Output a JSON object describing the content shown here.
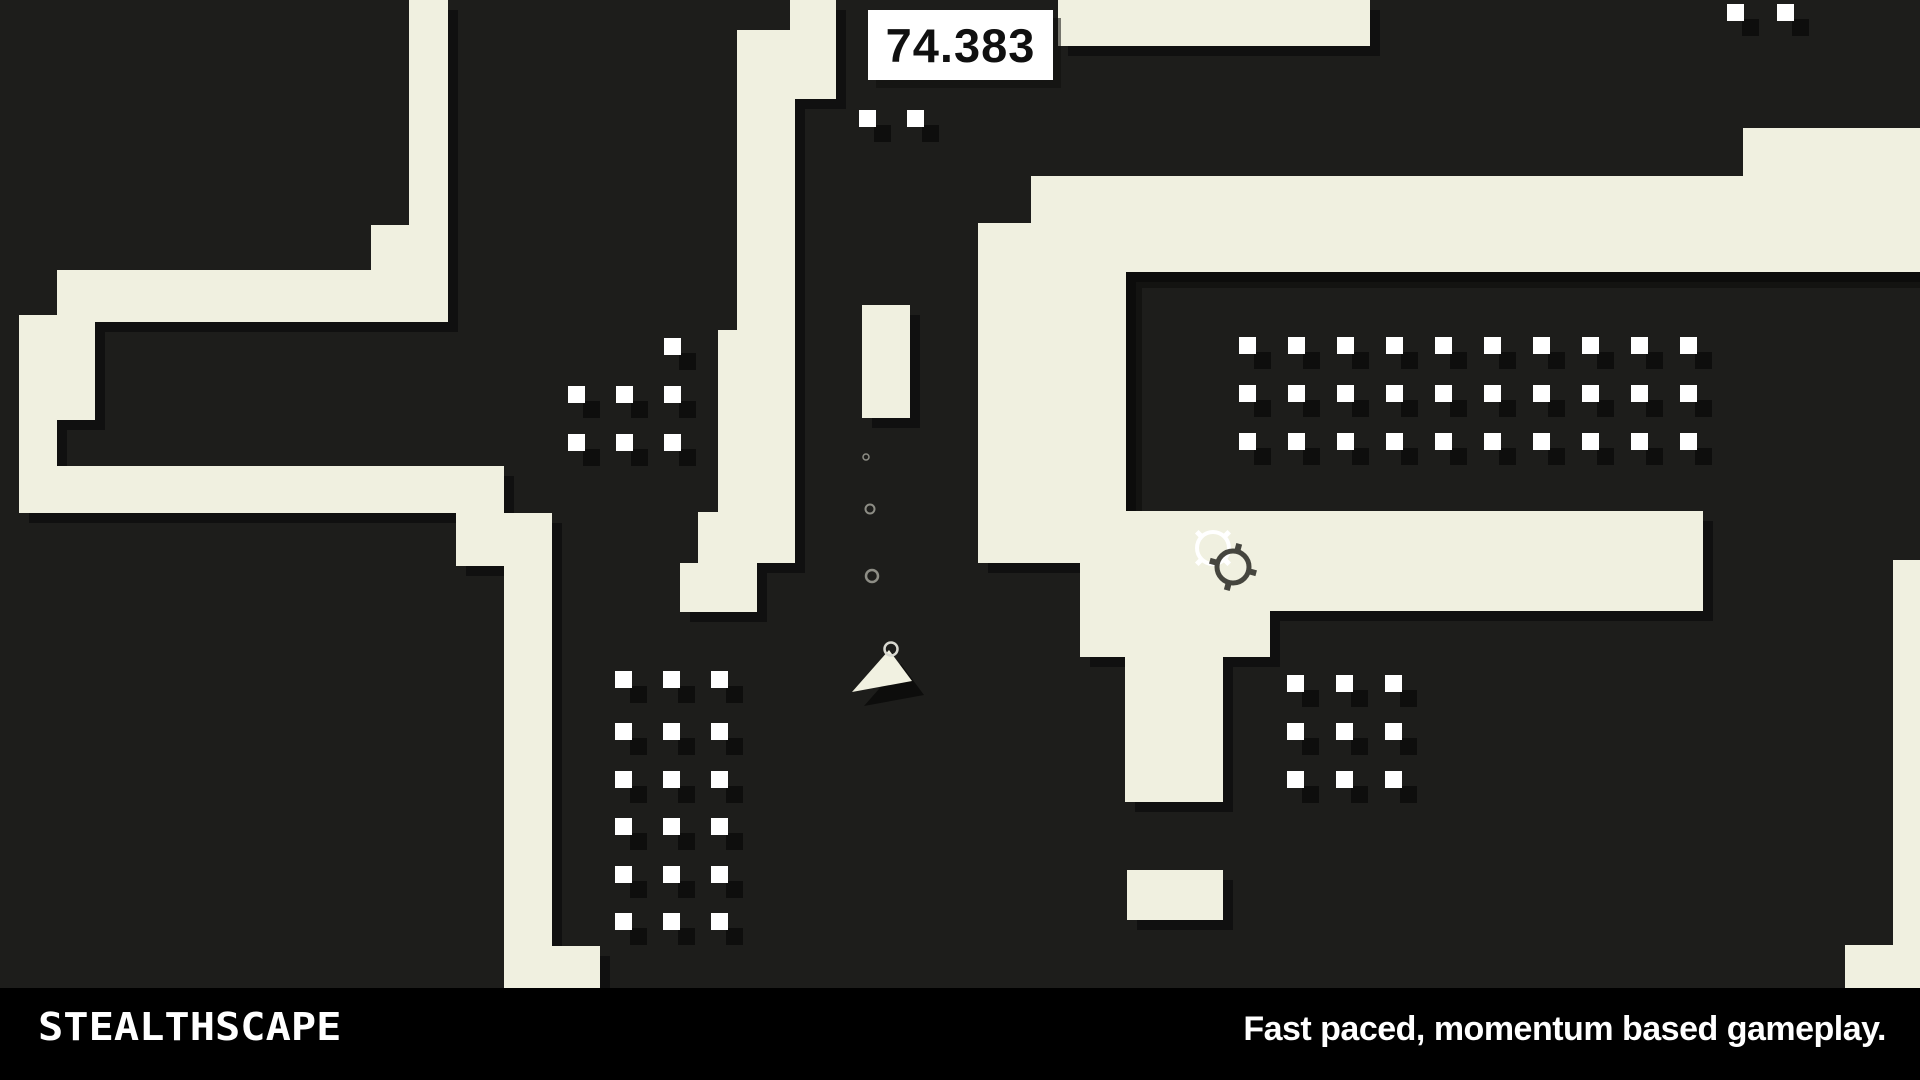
{
  "hud": {
    "timer_value": "74.383"
  },
  "branding": {
    "logo_text": "STEALTHSCAPE",
    "tagline": "Fast paced, momentum based gameplay."
  },
  "colors": {
    "background": "#1d1d1b",
    "wall": "#f0f0e0",
    "wall_shadow": "#101010",
    "dot": "#ffffff",
    "dot_shadow": "#0e0e0d",
    "bottom_bar": "#000000",
    "timer_box": "#ffffff",
    "timer_text": "#101010",
    "player": "#f1f1e1",
    "trail_ring": "#8d8d85",
    "crosshair_light": "#ffffff",
    "crosshair_dark": "#45453e"
  },
  "playfield": {
    "shadow_offset": {
      "x": 10,
      "y": 10
    },
    "dot_shadow_offset": {
      "x": 15,
      "y": 15
    },
    "walls": [
      {
        "name": "left-trunk",
        "x": 409,
        "y": 0,
        "w": 39,
        "h": 270
      },
      {
        "name": "left-trunk-step",
        "x": 371,
        "y": 225,
        "w": 38,
        "h": 45
      },
      {
        "name": "left-upper-bar",
        "x": 57,
        "y": 270,
        "w": 391,
        "h": 52
      },
      {
        "name": "left-end-top",
        "x": 19,
        "y": 315,
        "w": 76,
        "h": 45
      },
      {
        "name": "left-column",
        "x": 19,
        "y": 360,
        "w": 38,
        "h": 106
      },
      {
        "name": "left-column-step",
        "x": 57,
        "y": 360,
        "w": 38,
        "h": 60
      },
      {
        "name": "left-lower-bar",
        "x": 19,
        "y": 466,
        "w": 485,
        "h": 47
      },
      {
        "name": "left-stair",
        "x": 456,
        "y": 513,
        "w": 96,
        "h": 53
      },
      {
        "name": "left-corridor",
        "x": 504,
        "y": 513,
        "w": 48,
        "h": 433
      },
      {
        "name": "left-corridor-foot",
        "x": 504,
        "y": 946,
        "w": 96,
        "h": 42
      },
      {
        "name": "center-top-right",
        "x": 790,
        "y": 0,
        "w": 46,
        "h": 99
      },
      {
        "name": "center-upper",
        "x": 737,
        "y": 30,
        "w": 58,
        "h": 300
      },
      {
        "name": "center-lower",
        "x": 718,
        "y": 330,
        "w": 77,
        "h": 182
      },
      {
        "name": "center-wide",
        "x": 698,
        "y": 512,
        "w": 97,
        "h": 51
      },
      {
        "name": "center-bottom-step",
        "x": 680,
        "y": 563,
        "w": 77,
        "h": 49
      },
      {
        "name": "center-block",
        "x": 862,
        "y": 305,
        "w": 48,
        "h": 113
      },
      {
        "name": "right-top-strip",
        "x": 1058,
        "y": 0,
        "w": 312,
        "h": 46
      },
      {
        "name": "right-band-top",
        "x": 1031,
        "y": 176,
        "w": 889,
        "h": 96
      },
      {
        "name": "right-wall-stub",
        "x": 1743,
        "y": 128,
        "w": 177,
        "h": 48
      },
      {
        "name": "right-arm",
        "x": 978,
        "y": 223,
        "w": 148,
        "h": 340
      },
      {
        "name": "right-connector",
        "x": 1080,
        "y": 563,
        "w": 46,
        "h": 48
      },
      {
        "name": "right-band-bottom",
        "x": 1126,
        "y": 511,
        "w": 577,
        "h": 100
      },
      {
        "name": "right-band-step",
        "x": 1080,
        "y": 611,
        "w": 190,
        "h": 46
      },
      {
        "name": "right-descender",
        "x": 1125,
        "y": 657,
        "w": 98,
        "h": 145
      },
      {
        "name": "right-block",
        "x": 1127,
        "y": 870,
        "w": 96,
        "h": 50
      },
      {
        "name": "bottomright-sliver",
        "x": 1893,
        "y": 560,
        "w": 27,
        "h": 428
      },
      {
        "name": "bottomright-foot",
        "x": 1845,
        "y": 945,
        "w": 75,
        "h": 43
      }
    ],
    "interior_shade": {
      "x": 1126,
      "y": 272,
      "w": 794,
      "h": 239
    },
    "dot_size": 17,
    "dot_grids": [
      {
        "name": "top-center-pair",
        "cols": [
          859,
          907
        ],
        "rows": [
          110
        ]
      },
      {
        "name": "top-right-pair",
        "cols": [
          1727,
          1777
        ],
        "rows": [
          4
        ]
      },
      {
        "name": "middle-left-grid",
        "points": [
          [
            664,
            338
          ],
          [
            568,
            386
          ],
          [
            616,
            386
          ],
          [
            664,
            386
          ],
          [
            568,
            434
          ],
          [
            616,
            434
          ],
          [
            664,
            434
          ]
        ]
      },
      {
        "name": "bottom-left-grid",
        "cols": [
          615,
          663,
          711
        ],
        "rows": [
          671,
          723,
          771,
          818,
          866,
          913
        ]
      },
      {
        "name": "interior-grid",
        "cols": [
          1239,
          1288,
          1337,
          1386,
          1435,
          1484,
          1533,
          1582,
          1631,
          1680
        ],
        "rows": [
          337,
          385,
          433
        ]
      },
      {
        "name": "bottom-middle-grid",
        "cols": [
          1287,
          1336,
          1385
        ],
        "rows": [
          675,
          723,
          771
        ]
      }
    ],
    "player": {
      "triangle": [
        [
          889,
          650
        ],
        [
          912,
          681
        ],
        [
          852,
          692
        ]
      ],
      "shadow_offset": {
        "x": 12,
        "y": 14
      },
      "ring": {
        "cx": 891,
        "cy": 649,
        "r": 6.5
      }
    },
    "trail_rings": [
      {
        "cx": 866,
        "cy": 457,
        "r": 3,
        "w": 1.5
      },
      {
        "cx": 870,
        "cy": 509,
        "r": 4.5,
        "w": 2
      },
      {
        "cx": 872,
        "cy": 576,
        "r": 6,
        "w": 2.5
      }
    ],
    "crosshairs": [
      {
        "name": "crosshair-light",
        "cx": 1213,
        "cy": 548,
        "r": 16,
        "stroke_w": 4,
        "tick_angle_offset": 45,
        "tick_len": 7,
        "color_key": "crosshair_light"
      },
      {
        "name": "crosshair-dark",
        "cx": 1233,
        "cy": 567,
        "r": 16,
        "stroke_w": 5,
        "tick_angle_offset": 15,
        "tick_len": 8,
        "color_key": "crosshair_dark"
      }
    ]
  }
}
